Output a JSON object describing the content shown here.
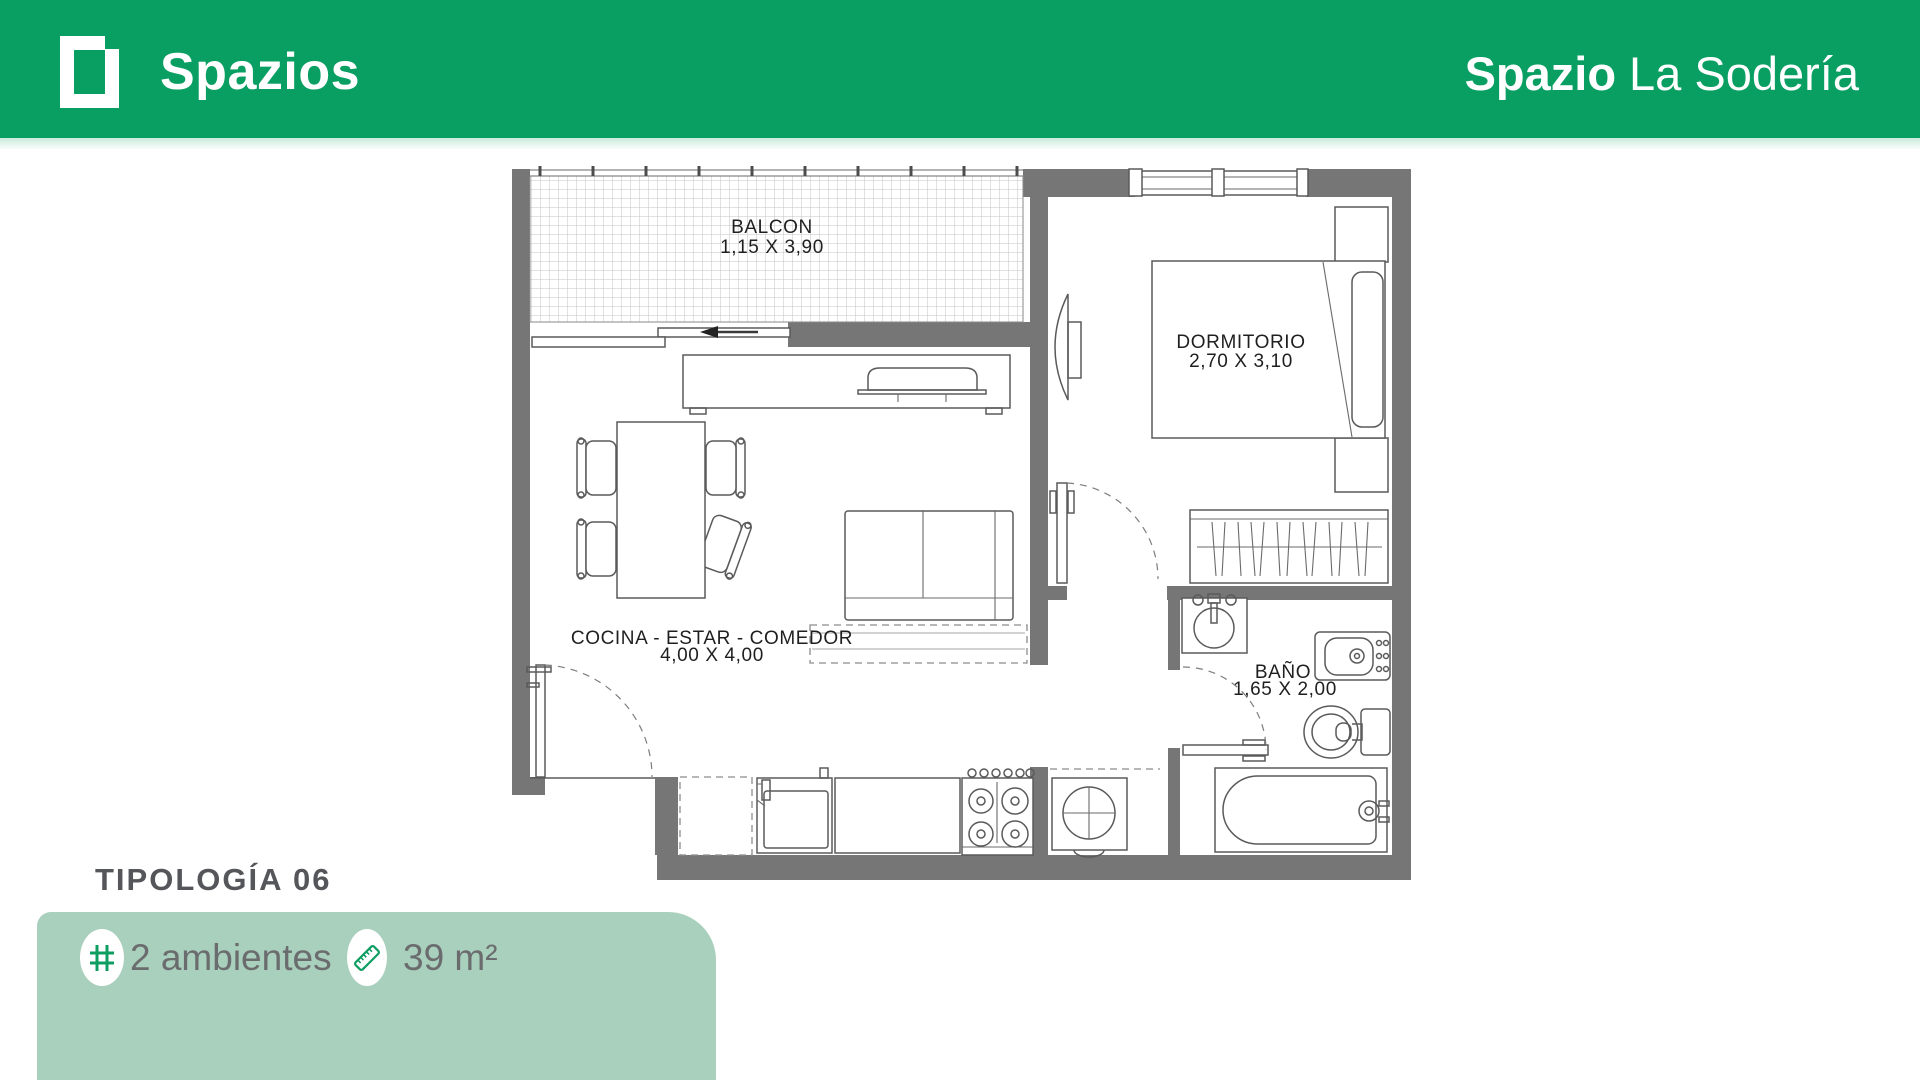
{
  "header": {
    "brand": "Spazios",
    "project": {
      "bold": "Spazio",
      "regular": "La Sodería"
    },
    "bg_color": "#0a9f62"
  },
  "plan": {
    "wall_color": "#767676",
    "rooms": [
      {
        "name": "BALCON",
        "dims": "1,15 X 3,90"
      },
      {
        "name": "DORMITORIO",
        "dims": "2,70 X 3,10"
      },
      {
        "name": "COCINA - ESTAR - COMEDOR",
        "dims": "4,00 X 4,00"
      },
      {
        "name": "BAÑO",
        "dims": "1,65 X 2,00"
      }
    ]
  },
  "footer": {
    "typology": "TIPOLOGÍA  06",
    "card": {
      "bg_color": "#a9cfbd",
      "items": [
        {
          "icon": "grid-icon",
          "label": "2 ambientes"
        },
        {
          "icon": "ruler-icon",
          "label": "39 m²"
        }
      ]
    }
  }
}
